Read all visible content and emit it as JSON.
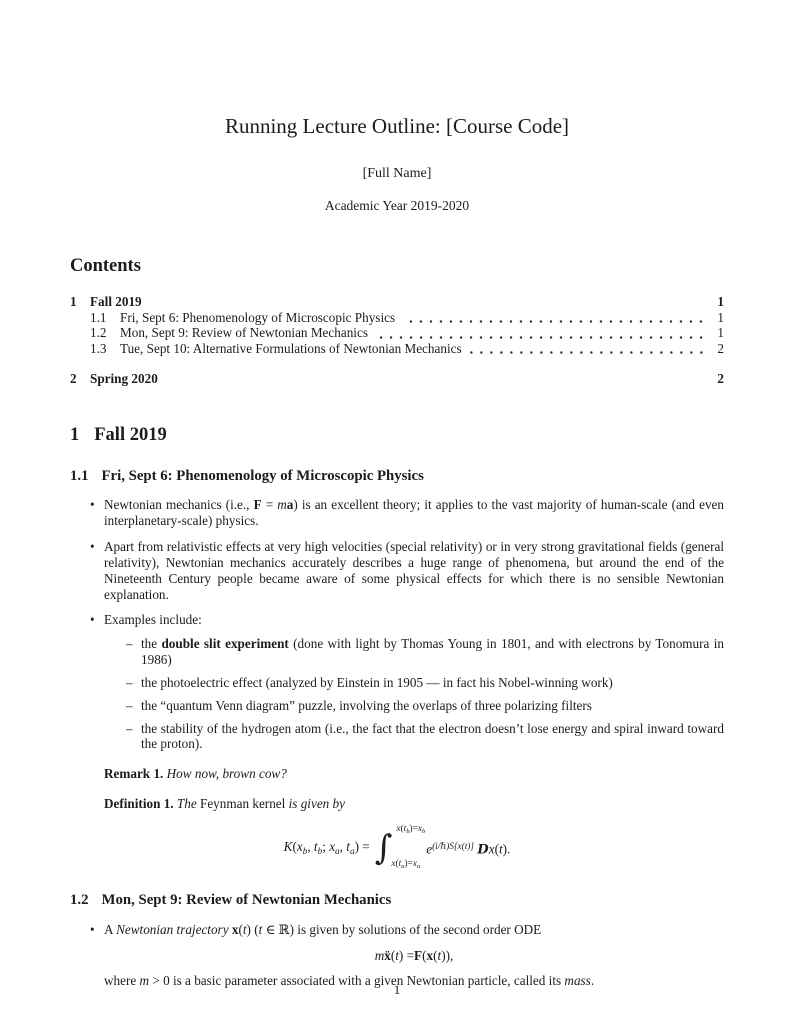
{
  "colors": {
    "text": "#1c1c1c",
    "background": "#ffffff"
  },
  "doc": {
    "title": "Running Lecture Outline: [Course Code]",
    "author": "[Full Name]",
    "date": "Academic Year 2019-2020",
    "page_number": "1"
  },
  "markers": {
    "bullet": "•",
    "dash": "–",
    "integral": "∫"
  },
  "contents": {
    "heading": "Contents",
    "entries": [
      {
        "number": "1",
        "title": "Fall 2019",
        "page": "1"
      },
      {
        "number": "1.1",
        "title": "Fri, Sept 6: Phenomenology of Microscopic Physics",
        "page": "1"
      },
      {
        "number": "1.2",
        "title": "Mon, Sept 9: Review of Newtonian Mechanics",
        "page": "1"
      },
      {
        "number": "1.3",
        "title": "Tue, Sept 10: Alternative Formulations of Newtonian Mechanics",
        "page": "2"
      },
      {
        "number": "2",
        "title": "Spring 2020",
        "page": "2"
      }
    ]
  },
  "section1": {
    "number": "1",
    "title": "Fall 2019"
  },
  "sub11": {
    "number": "1.1",
    "title": "Fri, Sept 6: Phenomenology of Microscopic Physics",
    "b1": [
      {
        "t": "Newtonian mechanics (i.e., "
      },
      {
        "t": "F",
        "s": "b"
      },
      {
        "t": " = "
      },
      {
        "t": "m",
        "s": "i"
      },
      {
        "t": "a",
        "s": "b"
      },
      {
        "t": ") is an excellent theory; it applies to the vast majority of human-scale (and even interplanetary-scale) physics."
      }
    ],
    "b2": [
      {
        "t": "Apart from relativistic effects at very high velocities (special relativity) or in very strong gravitational fields (general relativity), Newtonian mechanics accurately describes a huge range of phenomena, but around the end of the Nineteenth Century people became aware of some physical effects for which there is no sensible Newtonian explanation."
      }
    ],
    "b3": [
      {
        "t": "Examples include:"
      }
    ],
    "d1": [
      {
        "t": "the "
      },
      {
        "t": "double slit experiment",
        "s": "b"
      },
      {
        "t": " (done with light by Thomas Young in 1801, and with electrons by Tonomura in 1986)"
      }
    ],
    "d2": [
      {
        "t": "the photoelectric effect (analyzed by Einstein in 1905 — in fact his Nobel-winning work)"
      }
    ],
    "d3": [
      {
        "t": "the “quantum Venn diagram” puzzle, involving the overlaps of three polarizing filters"
      }
    ],
    "d4": [
      {
        "t": "the stability of the hydrogen atom (i.e., the fact that the electron doesn’t lose energy and spiral inward toward the proton)."
      }
    ],
    "remark": [
      {
        "t": "Remark 1.",
        "s": "b"
      },
      {
        "t": "  "
      },
      {
        "t": "How now, brown cow?",
        "s": "i"
      }
    ],
    "definition": [
      {
        "t": "Definition 1.",
        "s": "b"
      },
      {
        "t": "  "
      },
      {
        "t": "The ",
        "s": "i"
      },
      {
        "t": "Feynman kernel"
      },
      {
        "t": " is given by",
        "s": "i"
      }
    ]
  },
  "math": {
    "feynman": {
      "lhs": [
        {
          "t": "K",
          "s": "i"
        },
        {
          "t": "("
        },
        {
          "t": "x",
          "s": "i"
        },
        {
          "t": "b",
          "s": "i sub"
        },
        {
          "t": ", "
        },
        {
          "t": "t",
          "s": "i"
        },
        {
          "t": "b",
          "s": "i sub"
        },
        {
          "t": "; "
        },
        {
          "t": "x",
          "s": "i"
        },
        {
          "t": "a",
          "s": "i sub"
        },
        {
          "t": ", "
        },
        {
          "t": "t",
          "s": "i"
        },
        {
          "t": "a",
          "s": "i sub"
        },
        {
          "t": ") = "
        }
      ],
      "upper": [
        {
          "t": "x",
          "s": "i"
        },
        {
          "t": "("
        },
        {
          "t": "t",
          "s": "i"
        },
        {
          "t": "b",
          "s": "i sub"
        },
        {
          "t": ")="
        },
        {
          "t": "x",
          "s": "i"
        },
        {
          "t": "b",
          "s": "i sub"
        }
      ],
      "lower": [
        {
          "t": "x",
          "s": "i"
        },
        {
          "t": "("
        },
        {
          "t": "t",
          "s": "i"
        },
        {
          "t": "a",
          "s": "i sub"
        },
        {
          "t": ")="
        },
        {
          "t": "x",
          "s": "i"
        },
        {
          "t": "a",
          "s": "i sub"
        }
      ],
      "rhs": [
        {
          "t": "e",
          "s": "i"
        },
        {
          "t": "(i/ℏ)S[x(t)]",
          "s": "i sup"
        },
        {
          "t": " "
        },
        {
          "t": "D",
          "s": "script"
        },
        {
          "t": "x",
          "s": "i"
        },
        {
          "t": "("
        },
        {
          "t": "t",
          "s": "i"
        },
        {
          "t": ")."
        }
      ]
    },
    "newton_ode": [
      {
        "t": "m",
        "s": "i"
      },
      {
        "t": " "
      },
      {
        "t": "ẍ",
        "s": "b"
      },
      {
        "t": "("
      },
      {
        "t": "t",
        "s": "i"
      },
      {
        "t": ") = "
      },
      {
        "t": "F",
        "s": "b"
      },
      {
        "t": "("
      },
      {
        "t": "x",
        "s": "b"
      },
      {
        "t": "("
      },
      {
        "t": "t",
        "s": "i"
      },
      {
        "t": ")),"
      }
    ]
  },
  "sub12": {
    "number": "1.2",
    "title": "Mon, Sept 9: Review of Newtonian Mechanics",
    "b1": [
      {
        "t": "A "
      },
      {
        "t": "Newtonian trajectory",
        "s": "i"
      },
      {
        "t": " "
      },
      {
        "t": "x",
        "s": "b"
      },
      {
        "t": "("
      },
      {
        "t": "t",
        "s": "i"
      },
      {
        "t": ") ("
      },
      {
        "t": "t",
        "s": "i"
      },
      {
        "t": " ∈ ℝ) is given by solutions of the second order ODE"
      }
    ],
    "b1_cont": [
      {
        "t": "where "
      },
      {
        "t": "m",
        "s": "i"
      },
      {
        "t": " > 0 is a basic parameter associated with a given Newtonian particle, called its "
      },
      {
        "t": "mass",
        "s": "i"
      },
      {
        "t": "."
      }
    ]
  }
}
